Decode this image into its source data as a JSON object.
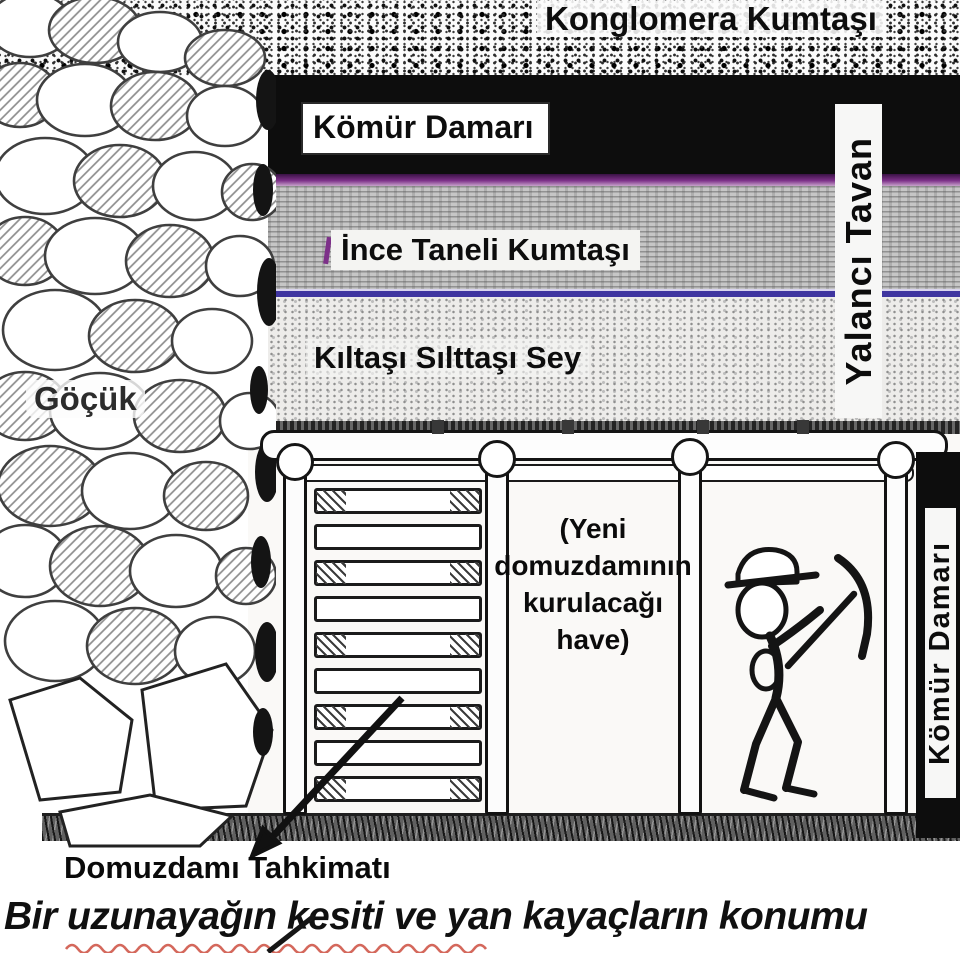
{
  "diagram": {
    "caption": "Bir uzunayağın kesiti ve yan kayaçların konumu",
    "strata": {
      "conglomerate_label": "Konglomera Kumtaşı",
      "coal_seam_label": "Kömür Damarı",
      "fine_sandstone_label": "İnce Taneli Kumtaşı",
      "claystone_label": "Kıltaşı Sılttaşı Sey",
      "false_roof_label": "Yalancı Tavan"
    },
    "mine": {
      "goaf_label": "Göçük",
      "crib_label": "Domuzdamı Tahkimatı",
      "coal_face_label": "Kömür Damarı",
      "note_lines": [
        "(Yeni",
        "domuzdamının",
        "kurulacağı",
        "have)"
      ]
    },
    "colors": {
      "coal": "#0d0d0d",
      "magenta_line": "#7d3189",
      "violet_line": "#3f35a0",
      "red_underline": "#d4685c"
    }
  }
}
